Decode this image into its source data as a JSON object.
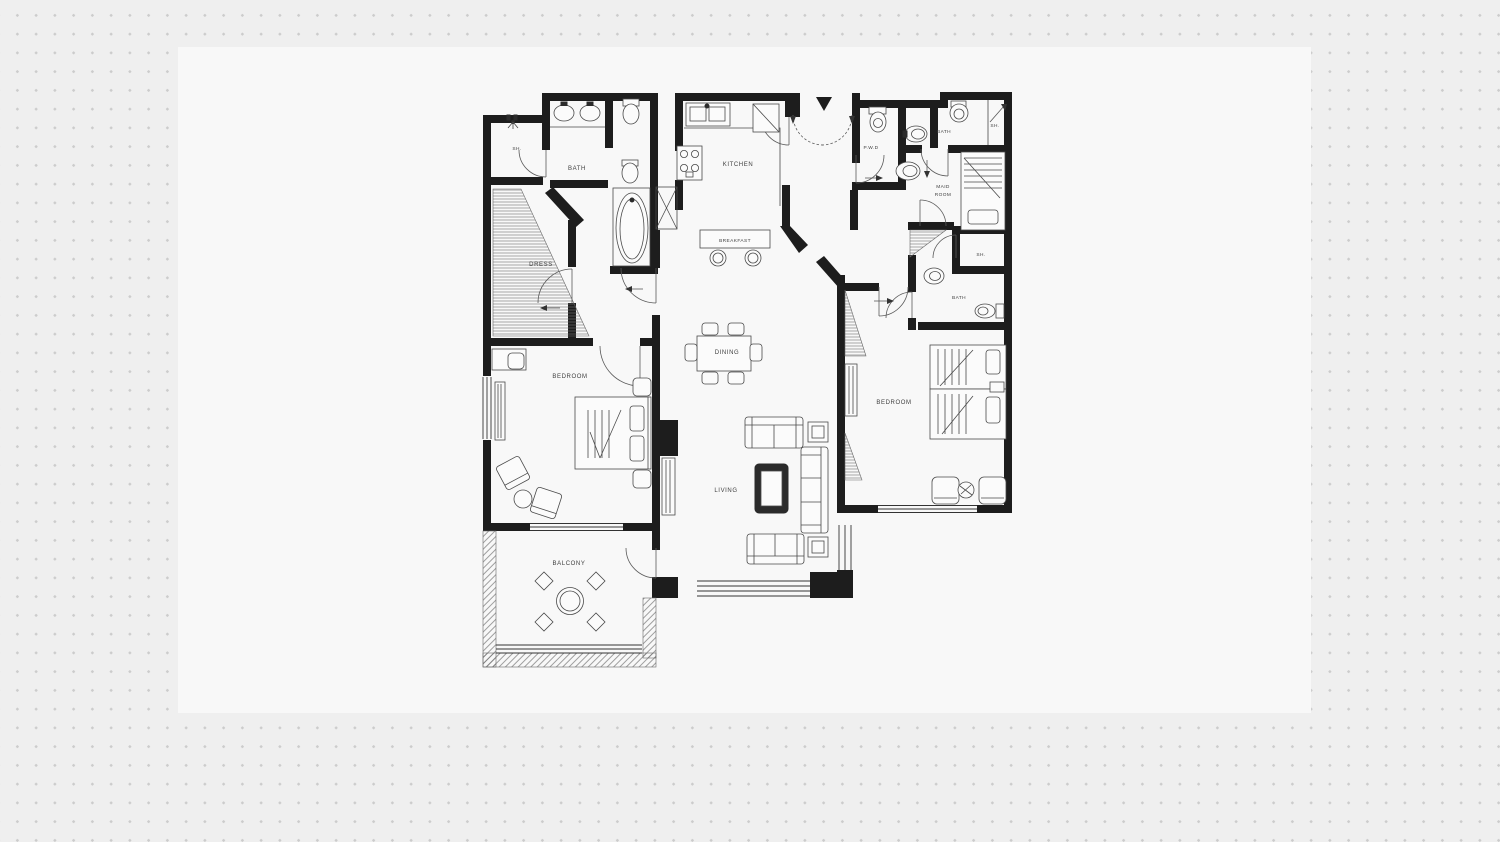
{
  "page": {
    "colors": {
      "background": "#efefef",
      "sheet": "#f8f8f8",
      "dots": "#cccccc",
      "walls": "#1d1d1d",
      "lines": "#4a4a4a",
      "label": "#3f3f3f"
    }
  },
  "floor_plan": {
    "rooms": {
      "sh_top_left": "SH.",
      "bath_top_left": "BATH",
      "dress": "DRESS",
      "kitchen": "KITCHEN",
      "breakfast": "BREAKFAST",
      "pwd": "P.W.D",
      "bath_top_right": "BATH",
      "sh_top_right": "SH.",
      "maid_room_line1": "MAID",
      "maid_room_line2": "ROOM",
      "sh_right": "SH.",
      "bath_right": "BATH",
      "bedroom_left": "BEDROOM",
      "dining": "DINING",
      "living": "LIVING",
      "bedroom_right": "BEDROOM",
      "balcony": "BALCONY"
    }
  }
}
